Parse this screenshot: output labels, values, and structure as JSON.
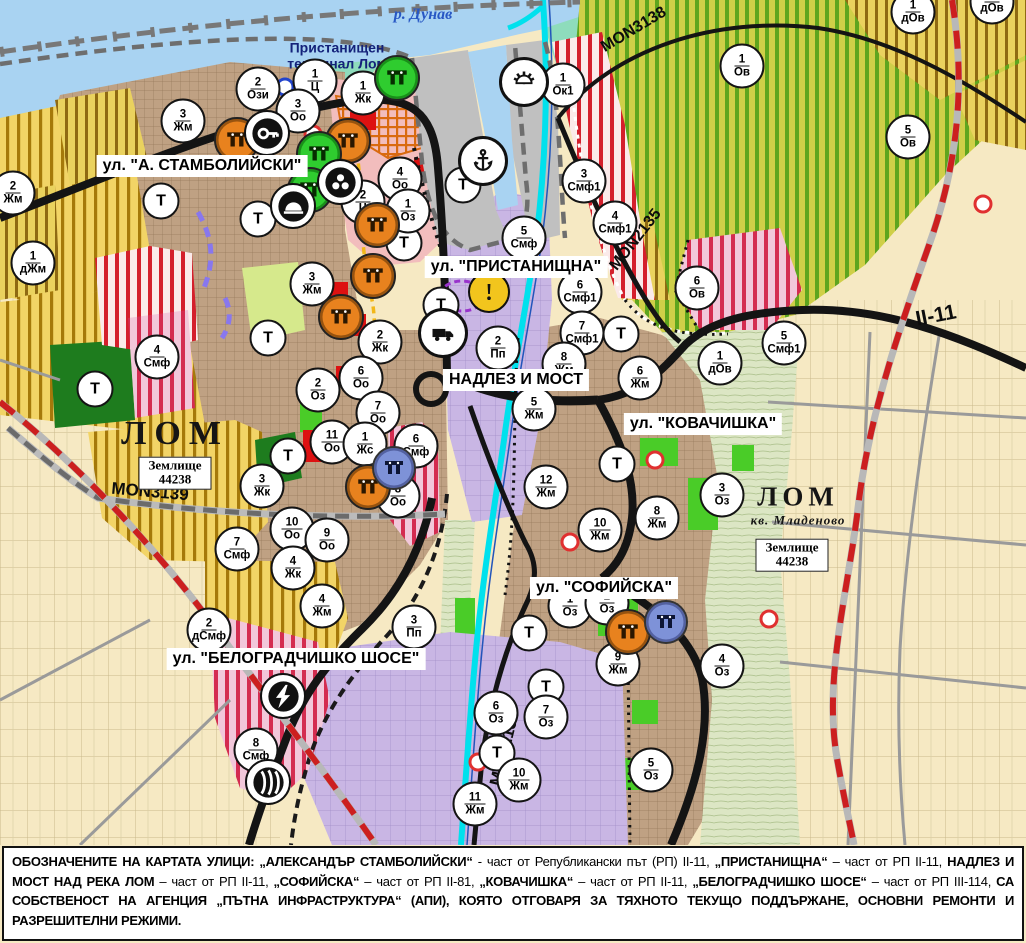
{
  "map": {
    "water_label": "р. Дунав",
    "port_label": "Пристанищен терминал Лом",
    "t_label": "Т",
    "street_labels": [
      {
        "text": "ул. \"А. СТАМБОЛИЙСКИ\"",
        "x": 202,
        "y": 166
      },
      {
        "text": "ул. \"ПРИСТАНИЩНА\"",
        "x": 516,
        "y": 267
      },
      {
        "text": "НАДЛЕЗ И МОСТ",
        "x": 516,
        "y": 380
      },
      {
        "text": "ул. \"КОВАЧИШКА\"",
        "x": 703,
        "y": 424
      },
      {
        "text": "ул. \"СОФИЙСКА\"",
        "x": 604,
        "y": 588
      },
      {
        "text": "ул. \"БЕЛОГРАДЧИШКО ШОСЕ\"",
        "x": 296,
        "y": 659
      }
    ],
    "city_labels": [
      {
        "name": "ЛОМ",
        "sub": "",
        "x": 175,
        "y": 434,
        "size": 34,
        "ls": 8
      },
      {
        "name": "ЛОМ",
        "sub": "кв. Младеново",
        "x": 798,
        "y": 505,
        "size": 27,
        "ls": 5
      }
    ],
    "parcel_boxes": [
      {
        "l1": "Землище",
        "l2": "44238",
        "x": 175,
        "y": 473
      },
      {
        "l1": "Землище",
        "l2": "44238",
        "x": 792,
        "y": 555
      }
    ],
    "road_labels": [
      {
        "text": "MON3139",
        "x": 150,
        "y": 492,
        "rot": 5,
        "size": 17
      },
      {
        "text": "MON3138",
        "x": 634,
        "y": 30,
        "rot": -31,
        "size": 16
      },
      {
        "text": "MON2135",
        "x": 636,
        "y": 240,
        "rot": -52,
        "size": 16
      },
      {
        "text": "MON2136",
        "x": 505,
        "y": 748,
        "rot": -76,
        "size": 17
      },
      {
        "text": "II-11",
        "x": 936,
        "y": 316,
        "rot": -11,
        "size": 21
      }
    ],
    "zone_markers": [
      {
        "n": "2",
        "c": "Ози",
        "x": 258,
        "y": 89
      },
      {
        "n": "1",
        "c": "Ц",
        "x": 315,
        "y": 81
      },
      {
        "n": "1",
        "c": "Жк",
        "x": 363,
        "y": 93
      },
      {
        "n": "3",
        "c": "Оо",
        "x": 298,
        "y": 111
      },
      {
        "n": "3",
        "c": "Жм",
        "x": 183,
        "y": 121
      },
      {
        "n": "2",
        "c": "Жм",
        "x": 13,
        "y": 193
      },
      {
        "n": "1",
        "c": "дЖм",
        "x": 33,
        "y": 263
      },
      {
        "n": "4",
        "c": "Оо",
        "x": 400,
        "y": 179
      },
      {
        "n": "2",
        "c": "Ц",
        "x": 363,
        "y": 202
      },
      {
        "n": "1",
        "c": "Оз",
        "x": 408,
        "y": 211
      },
      {
        "n": "3",
        "c": "Жм",
        "x": 312,
        "y": 284
      },
      {
        "n": "1",
        "c": "Ок1",
        "x": 563,
        "y": 85
      },
      {
        "n": "1",
        "c": "Ов",
        "x": 742,
        "y": 66
      },
      {
        "n": "1",
        "c": "дОв",
        "x": 913,
        "y": 12
      },
      {
        "n": "1",
        "c": "дОв",
        "x": 992,
        "y": 2
      },
      {
        "n": "5",
        "c": "Ов",
        "x": 908,
        "y": 137
      },
      {
        "n": "3",
        "c": "Смф1",
        "x": 584,
        "y": 181
      },
      {
        "n": "4",
        "c": "Смф1",
        "x": 615,
        "y": 223
      },
      {
        "n": "5",
        "c": "Смф",
        "x": 524,
        "y": 238
      },
      {
        "n": "6",
        "c": "Ов",
        "x": 697,
        "y": 288
      },
      {
        "n": "5",
        "c": "Смф1",
        "x": 784,
        "y": 343
      },
      {
        "n": "1",
        "c": "дОв",
        "x": 720,
        "y": 363
      },
      {
        "n": "6",
        "c": "Жм",
        "x": 640,
        "y": 378
      },
      {
        "n": "4",
        "c": "Смф",
        "x": 157,
        "y": 357
      },
      {
        "n": "2",
        "c": "Жк",
        "x": 380,
        "y": 342
      },
      {
        "n": "6",
        "c": "Оо",
        "x": 361,
        "y": 378
      },
      {
        "n": "2",
        "c": "Оз",
        "x": 318,
        "y": 390
      },
      {
        "n": "7",
        "c": "Оо",
        "x": 378,
        "y": 413
      },
      {
        "n": "11",
        "c": "Оо",
        "x": 332,
        "y": 442
      },
      {
        "n": "1",
        "c": "Жс",
        "x": 365,
        "y": 444
      },
      {
        "n": "6",
        "c": "Смф",
        "x": 416,
        "y": 446
      },
      {
        "n": "8",
        "c": "Оо",
        "x": 398,
        "y": 496
      },
      {
        "n": "3",
        "c": "Жк",
        "x": 262,
        "y": 486
      },
      {
        "n": "10",
        "c": "Оо",
        "x": 292,
        "y": 529
      },
      {
        "n": "9",
        "c": "Оо",
        "x": 327,
        "y": 540
      },
      {
        "n": "7",
        "c": "Смф",
        "x": 237,
        "y": 549
      },
      {
        "n": "4",
        "c": "Жк",
        "x": 293,
        "y": 568
      },
      {
        "n": "2",
        "c": "Пп",
        "x": 498,
        "y": 348
      },
      {
        "n": "6",
        "c": "Смф1",
        "x": 580,
        "y": 292
      },
      {
        "n": "7",
        "c": "Смф1",
        "x": 582,
        "y": 333
      },
      {
        "n": "8",
        "c": "Жм",
        "x": 564,
        "y": 364
      },
      {
        "n": "5",
        "c": "Жм",
        "x": 534,
        "y": 409
      },
      {
        "n": "12",
        "c": "Жм",
        "x": 546,
        "y": 487
      },
      {
        "n": "10",
        "c": "Жм",
        "x": 600,
        "y": 530
      },
      {
        "n": "8",
        "c": "Жм",
        "x": 657,
        "y": 518
      },
      {
        "n": "3",
        "c": "Оз",
        "x": 722,
        "y": 495
      },
      {
        "n": "2",
        "c": "дСмф",
        "x": 209,
        "y": 630
      },
      {
        "n": "4",
        "c": "Жм",
        "x": 322,
        "y": 606
      },
      {
        "n": "3",
        "c": "Пп",
        "x": 414,
        "y": 627
      },
      {
        "n": "8",
        "c": "Смф",
        "x": 256,
        "y": 750
      },
      {
        "n": "6",
        "c": "Оз",
        "x": 496,
        "y": 713
      },
      {
        "n": "11",
        "c": "Жм",
        "x": 475,
        "y": 804
      },
      {
        "n": "9",
        "c": "Жм",
        "x": 618,
        "y": 664
      },
      {
        "n": "4",
        "c": "Оз",
        "x": 722,
        "y": 666
      },
      {
        "n": "7",
        "c": "Оз",
        "x": 546,
        "y": 717
      },
      {
        "n": "10",
        "c": "Жм",
        "x": 519,
        "y": 780
      },
      {
        "n": "5",
        "c": "Оз",
        "x": 651,
        "y": 770
      },
      {
        "n": "1",
        "c": "Оз",
        "x": 570,
        "y": 606
      },
      {
        "n": "2",
        "c": "Оз",
        "x": 607,
        "y": 603
      }
    ],
    "t_markers": [
      [
        161,
        201
      ],
      [
        258,
        219
      ],
      [
        463,
        185
      ],
      [
        404,
        243
      ],
      [
        441,
        305
      ],
      [
        268,
        338
      ],
      [
        95,
        389
      ],
      [
        288,
        456
      ],
      [
        621,
        334
      ],
      [
        617,
        464
      ],
      [
        529,
        633
      ],
      [
        546,
        687
      ],
      [
        497,
        753
      ]
    ],
    "icon_markers": [
      {
        "t": "monument",
        "v": "orange",
        "x": 237,
        "y": 140
      },
      {
        "t": "monument",
        "v": "orange",
        "x": 348,
        "y": 141
      },
      {
        "t": "monument",
        "v": "orange",
        "x": 377,
        "y": 225
      },
      {
        "t": "monument",
        "v": "orange",
        "x": 373,
        "y": 276
      },
      {
        "t": "monument",
        "v": "orange",
        "x": 341,
        "y": 317
      },
      {
        "t": "monument",
        "v": "orange",
        "x": 368,
        "y": 487
      },
      {
        "t": "monument",
        "v": "orange",
        "x": 628,
        "y": 632
      },
      {
        "t": "monument",
        "v": "green",
        "x": 397,
        "y": 78
      },
      {
        "t": "monument",
        "v": "green",
        "x": 319,
        "y": 154
      },
      {
        "t": "monument",
        "v": "green",
        "x": 310,
        "y": 190
      },
      {
        "t": "monument",
        "v": "blue",
        "x": 394,
        "y": 468
      },
      {
        "t": "monument",
        "v": "blue",
        "x": 666,
        "y": 622
      },
      {
        "t": "anchor",
        "v": "plain",
        "x": 483,
        "y": 161
      },
      {
        "t": "sun",
        "v": "plain",
        "x": 524,
        "y": 82
      },
      {
        "t": "truck",
        "v": "plain",
        "x": 443,
        "y": 333
      },
      {
        "t": "key",
        "v": "bare",
        "x": 267,
        "y": 133
      },
      {
        "t": "group",
        "v": "bare",
        "x": 340,
        "y": 182
      },
      {
        "t": "tunnel",
        "v": "bare",
        "x": 293,
        "y": 206
      },
      {
        "t": "lightning",
        "v": "bare",
        "x": 283,
        "y": 696
      },
      {
        "t": "railstation",
        "v": "bare",
        "x": 268,
        "y": 782
      },
      {
        "t": "warning",
        "v": "warning",
        "x": 489,
        "y": 292
      }
    ],
    "ring_markers": [
      {
        "x": 123,
        "y": 166,
        "color": "#E03030"
      },
      {
        "x": 313,
        "y": 134,
        "color": "#E03030"
      },
      {
        "x": 655,
        "y": 460,
        "color": "#E03030"
      },
      {
        "x": 570,
        "y": 542,
        "color": "#E03030"
      },
      {
        "x": 769,
        "y": 619,
        "color": "#E03030"
      },
      {
        "x": 478,
        "y": 762,
        "color": "#E03030"
      },
      {
        "x": 983,
        "y": 204,
        "color": "#E03030"
      },
      {
        "x": 285,
        "y": 87,
        "color": "#2244CC"
      }
    ]
  },
  "colors": {
    "water": "#A9D3F2",
    "river_cyan": "#00E1ED",
    "urban_brown": "#BFA183",
    "vineyard_yellow": "#F2D466",
    "vineyard_stripe": "#A5790A",
    "forest_green_stripe": "#5FA51E",
    "industrial_purple": "#C9B6E4",
    "mixed_red_stripe": "#D41F2C",
    "park_green": "#1E7C1E",
    "boundary_red": "#CC1F1F",
    "old_town_pink": "#F2BDBD",
    "marker_orange": "#E8821E",
    "marker_green": "#2FCC2F",
    "marker_blue": "#7E92D8"
  },
  "footer": {
    "segments": [
      {
        "t": "ОБОЗНАЧЕНИТЕ НА КАРТАТА УЛИЦИ: „АЛЕКСАНДЪР СТАМБОЛИЙСКИ“",
        "b": true
      },
      {
        "t": " - част от Републикански път (РП) II-11, ",
        "b": false
      },
      {
        "t": "„ПРИСТАНИЩНА“",
        "b": true
      },
      {
        "t": " – част от РП II-11, ",
        "b": false
      },
      {
        "t": "НАДЛЕЗ И МОСТ НАД РЕКА ЛОМ",
        "b": true
      },
      {
        "t": " – част от РП II-11, ",
        "b": false
      },
      {
        "t": "„СОФИЙСКА“",
        "b": true
      },
      {
        "t": " – част от РП II-81, ",
        "b": false
      },
      {
        "t": "„КОВАЧИШКА“",
        "b": true
      },
      {
        "t": " – част от РП II-11, ",
        "b": false
      },
      {
        "t": "„БЕЛОГРАДЧИШКО ШОСЕ“",
        "b": true
      },
      {
        "t": " – част от РП III-114, ",
        "b": false
      },
      {
        "t": "СА СОБСТВЕНОСТ НА АГЕНЦИЯ „ПЪТНА ИНФРАСТРУКТУРА“ (АПИ), КОЯТО ОТГОВАРЯ ЗА ТЯХНОТО ТЕКУЩО ПОДДЪРЖАНЕ, ОСНОВНИ РЕМОНТИ И РАЗРЕШИТЕЛНИ РЕЖИМИ.",
        "b": true
      }
    ]
  }
}
